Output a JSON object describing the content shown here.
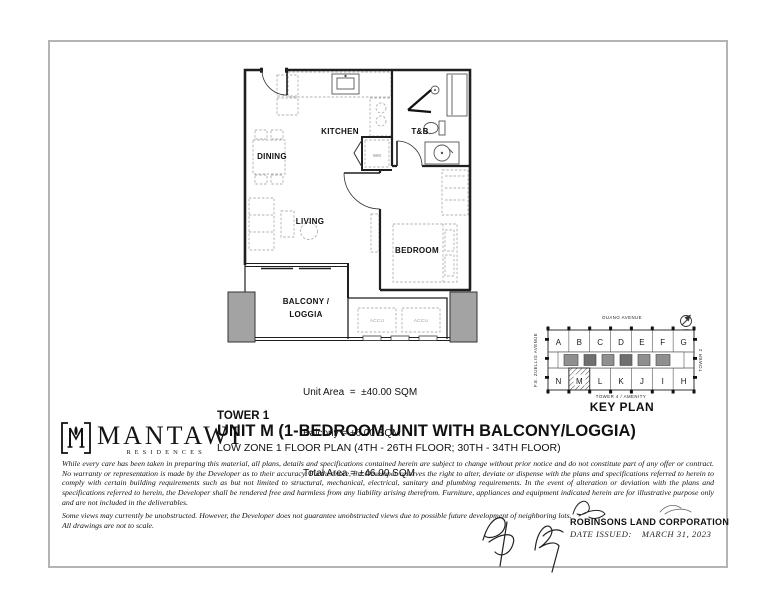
{
  "floor_plan": {
    "room_labels": {
      "kitchen": "KITCHEN",
      "dining": "DINING",
      "living": "LIVING",
      "bedroom": "BEDROOM",
      "toilet_bath": "T&B",
      "balcony_line1": "BALCONY /",
      "balcony_line2": "LOGGIA"
    },
    "equipment_labels": {
      "washing_machine": "WM",
      "accu_left": "ACCU",
      "accu_right": "ACCU"
    },
    "area_lines": {
      "unit": "Unit Area  =  ±40.00 SQM",
      "balcony": "Balcony = ±6.00 SQM",
      "total": "Total Area = ±46.00 SQM"
    }
  },
  "key_plan": {
    "title": "KEY PLAN",
    "street_top": "OUANO AVENUE",
    "street_left": "F.E. ZUELLIG AVENUE",
    "tower_right": "TOWER 2",
    "tower_bottom": "TOWER 4  /  AMENITY",
    "north_label": "NORTH",
    "top_row": [
      "A",
      "B",
      "C",
      "D",
      "E",
      "F",
      "G"
    ],
    "bottom_row": [
      "N",
      "M",
      "L",
      "K",
      "J",
      "I",
      "H"
    ],
    "highlighted_unit": "M"
  },
  "branding": {
    "name": "MANTAWI",
    "subtitle": "RESIDENCES"
  },
  "title_block": {
    "tower": "TOWER 1",
    "unit_title": "UNIT M (1-BEDROOM UNIT WITH BALCONY/LOGGIA)",
    "floor_range": "LOW ZONE 1 FLOOR PLAN (4TH - 26TH FLOOR; 30TH - 34TH FLOOR)"
  },
  "disclaimer": {
    "paragraph1": "While every care has been taken in preparing this material, all plans, details and specifications contained herein are subject to change without prior notice and do not constitute part of any offer or contract. No warranty or representation is made by the Developer as to their accuracy.  Furthermore, the Developer reserves the right to alter, deviate or dispense with the plans and specifications referred to herein to comply with certain building requirements such as but not limited to structural, mechanical, electrical, sanitary and plumbing requirements. In the event of alteration or deviation with the plans and specifications referred to herein, the Developer shall be rendered free and harmless from any liability arising therefrom. Furniture, appliances and equipment indicated herein are for illustrative purpose only and are not included in the deliverables.",
    "views_note": "Some views may currently be unobstructed.  However, the Developer does not guarantee unobstructed views due to possible future development of  neighboring lots.",
    "scale_note": "All drawings are not to scale."
  },
  "footer": {
    "company": "ROBINSONS LAND CORPORATION",
    "date_label": "DATE ISSUED:",
    "date_value": "MARCH 31, 2023"
  }
}
